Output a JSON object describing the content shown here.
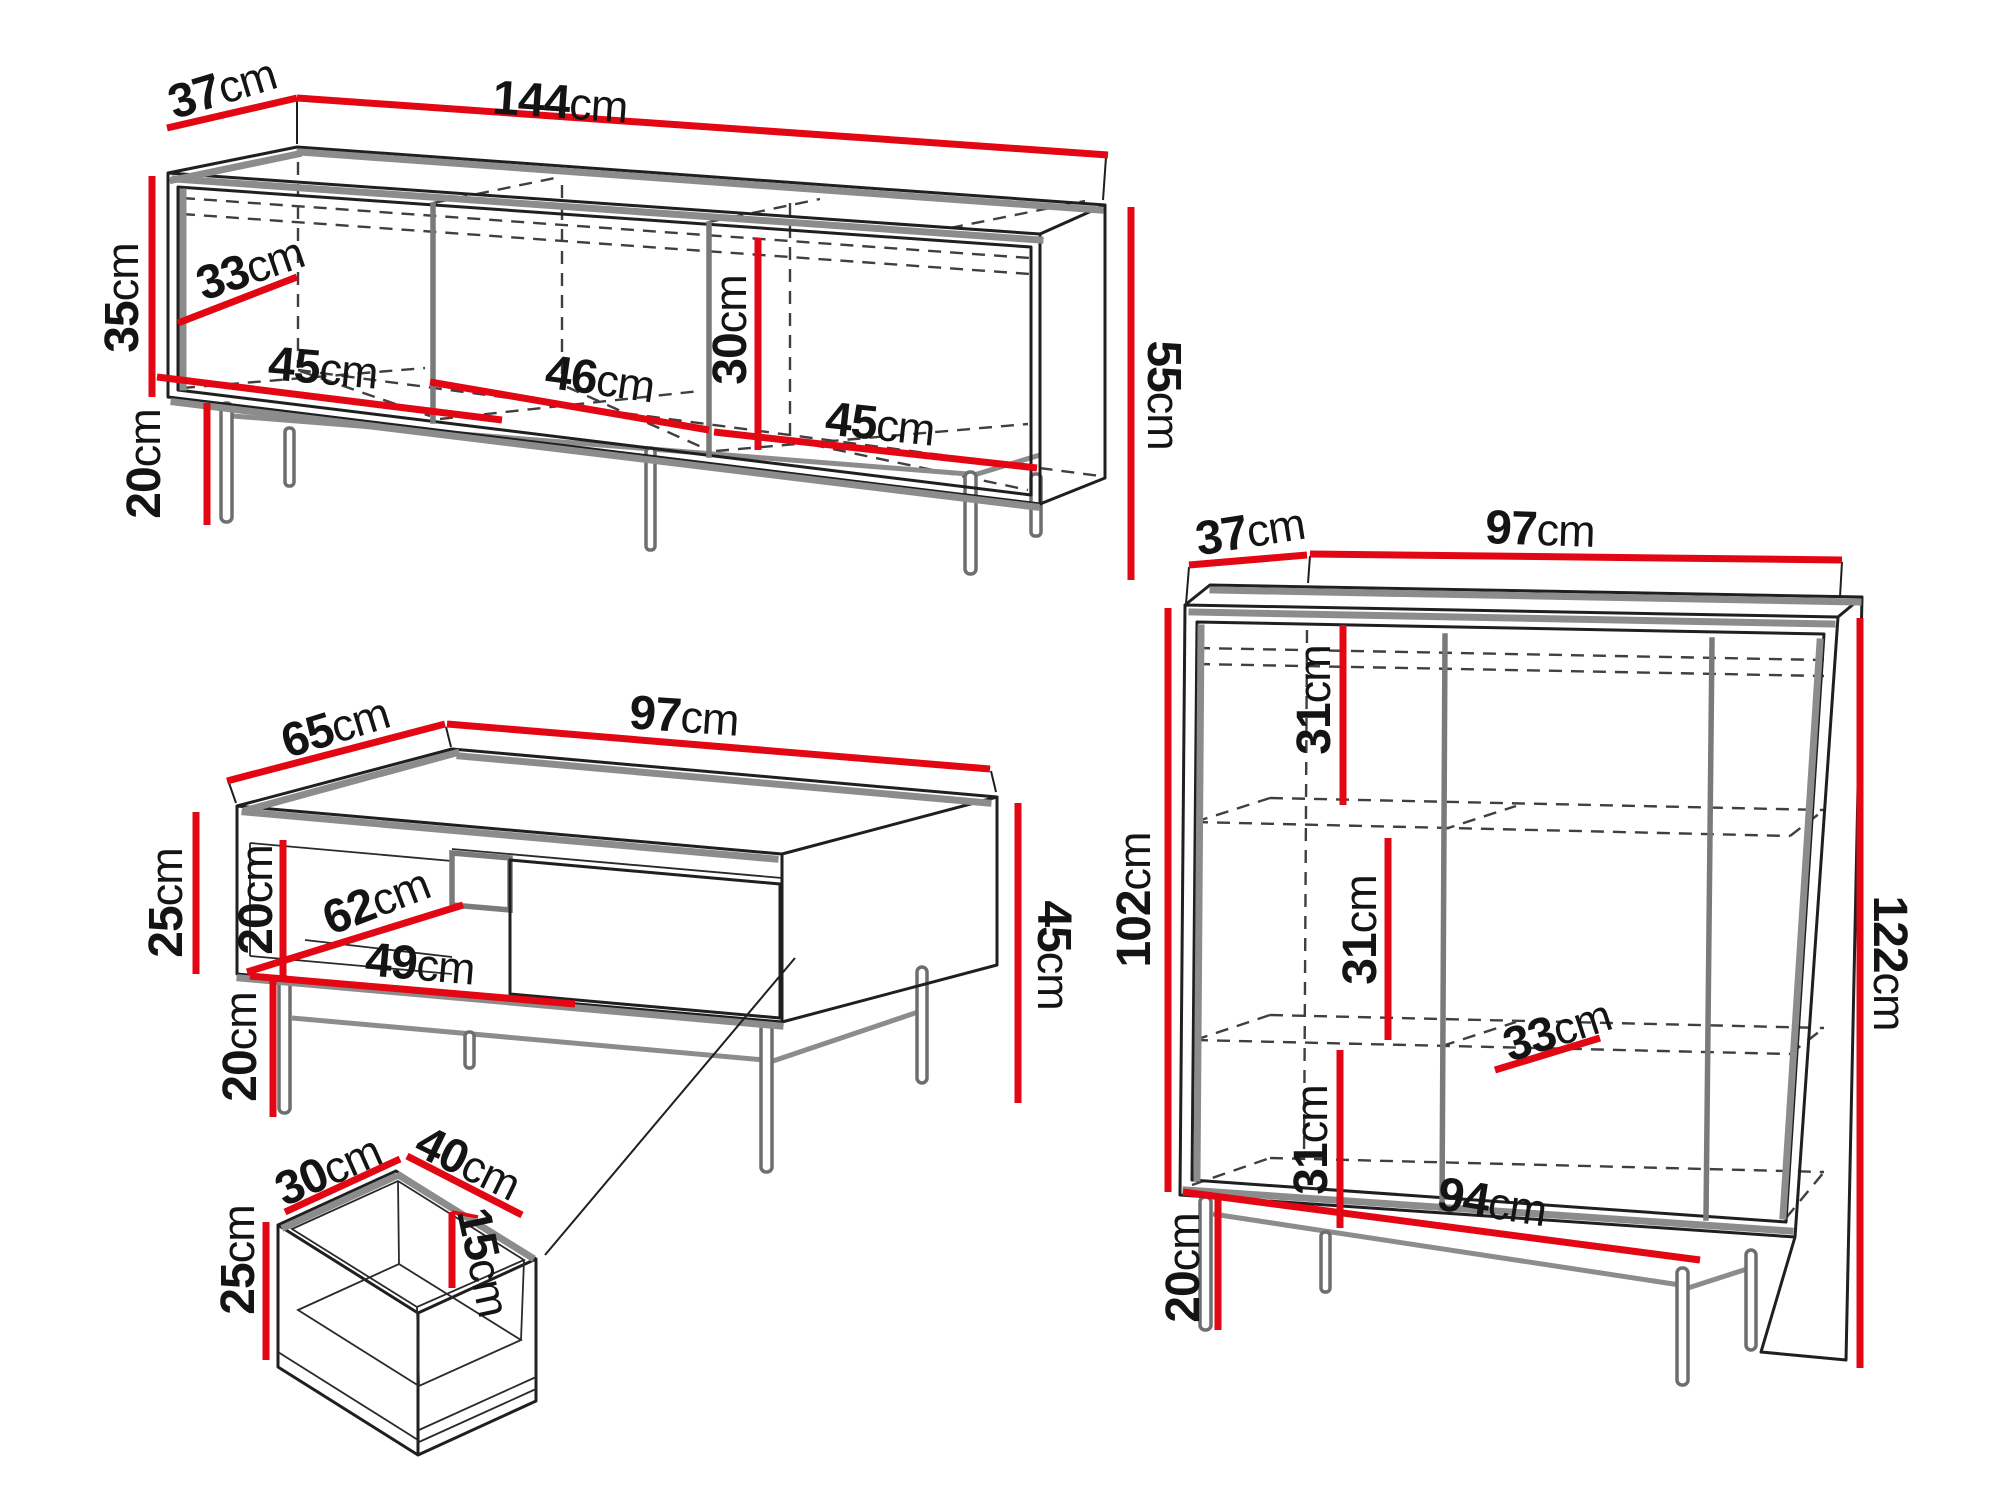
{
  "canvas": {
    "width": 2000,
    "height": 1499,
    "background": "#ffffff"
  },
  "colors": {
    "dimension_line": "#e30613",
    "outline": "#1f1f1f",
    "shading": "#8c8c8c",
    "hidden_edge": "#3f3f3f",
    "label_text": "#141414"
  },
  "unit": "cm",
  "pieces": {
    "tv_stand": {
      "dims": {
        "depth": {
          "value": "37",
          "unit": "cm"
        },
        "width": {
          "value": "144",
          "unit": "cm"
        },
        "interior_height": {
          "value": "35",
          "unit": "cm"
        },
        "interior_depth": {
          "value": "33",
          "unit": "cm"
        },
        "section_left": {
          "value": "45",
          "unit": "cm"
        },
        "section_middle": {
          "value": "46",
          "unit": "cm"
        },
        "opening_height": {
          "value": "30",
          "unit": "cm"
        },
        "section_right": {
          "value": "45",
          "unit": "cm"
        },
        "total_height": {
          "value": "55",
          "unit": "cm"
        },
        "leg_height": {
          "value": "20",
          "unit": "cm"
        }
      }
    },
    "coffee_table": {
      "dims": {
        "depth": {
          "value": "65",
          "unit": "cm"
        },
        "width": {
          "value": "97",
          "unit": "cm"
        },
        "body_height": {
          "value": "25",
          "unit": "cm"
        },
        "opening_height": {
          "value": "20",
          "unit": "cm"
        },
        "interior_depth": {
          "value": "62",
          "unit": "cm"
        },
        "opening_width": {
          "value": "49",
          "unit": "cm"
        },
        "leg_height": {
          "value": "20",
          "unit": "cm"
        },
        "total_height": {
          "value": "45",
          "unit": "cm"
        }
      }
    },
    "drawer": {
      "dims": {
        "depth": {
          "value": "30",
          "unit": "cm"
        },
        "width": {
          "value": "40",
          "unit": "cm"
        },
        "height": {
          "value": "25",
          "unit": "cm"
        },
        "interior_depth": {
          "value": "15",
          "unit": "cm"
        }
      }
    },
    "cabinet": {
      "dims": {
        "depth": {
          "value": "37",
          "unit": "cm"
        },
        "width": {
          "value": "97",
          "unit": "cm"
        },
        "body_height": {
          "value": "102",
          "unit": "cm"
        },
        "total_height": {
          "value": "122",
          "unit": "cm"
        },
        "compartment_top": {
          "value": "31",
          "unit": "cm"
        },
        "compartment_middle": {
          "value": "31",
          "unit": "cm"
        },
        "compartment_bottom": {
          "value": "31",
          "unit": "cm"
        },
        "shelf_depth": {
          "value": "33",
          "unit": "cm"
        },
        "interior_width": {
          "value": "94",
          "unit": "cm"
        },
        "leg_height": {
          "value": "20",
          "unit": "cm"
        }
      }
    }
  }
}
